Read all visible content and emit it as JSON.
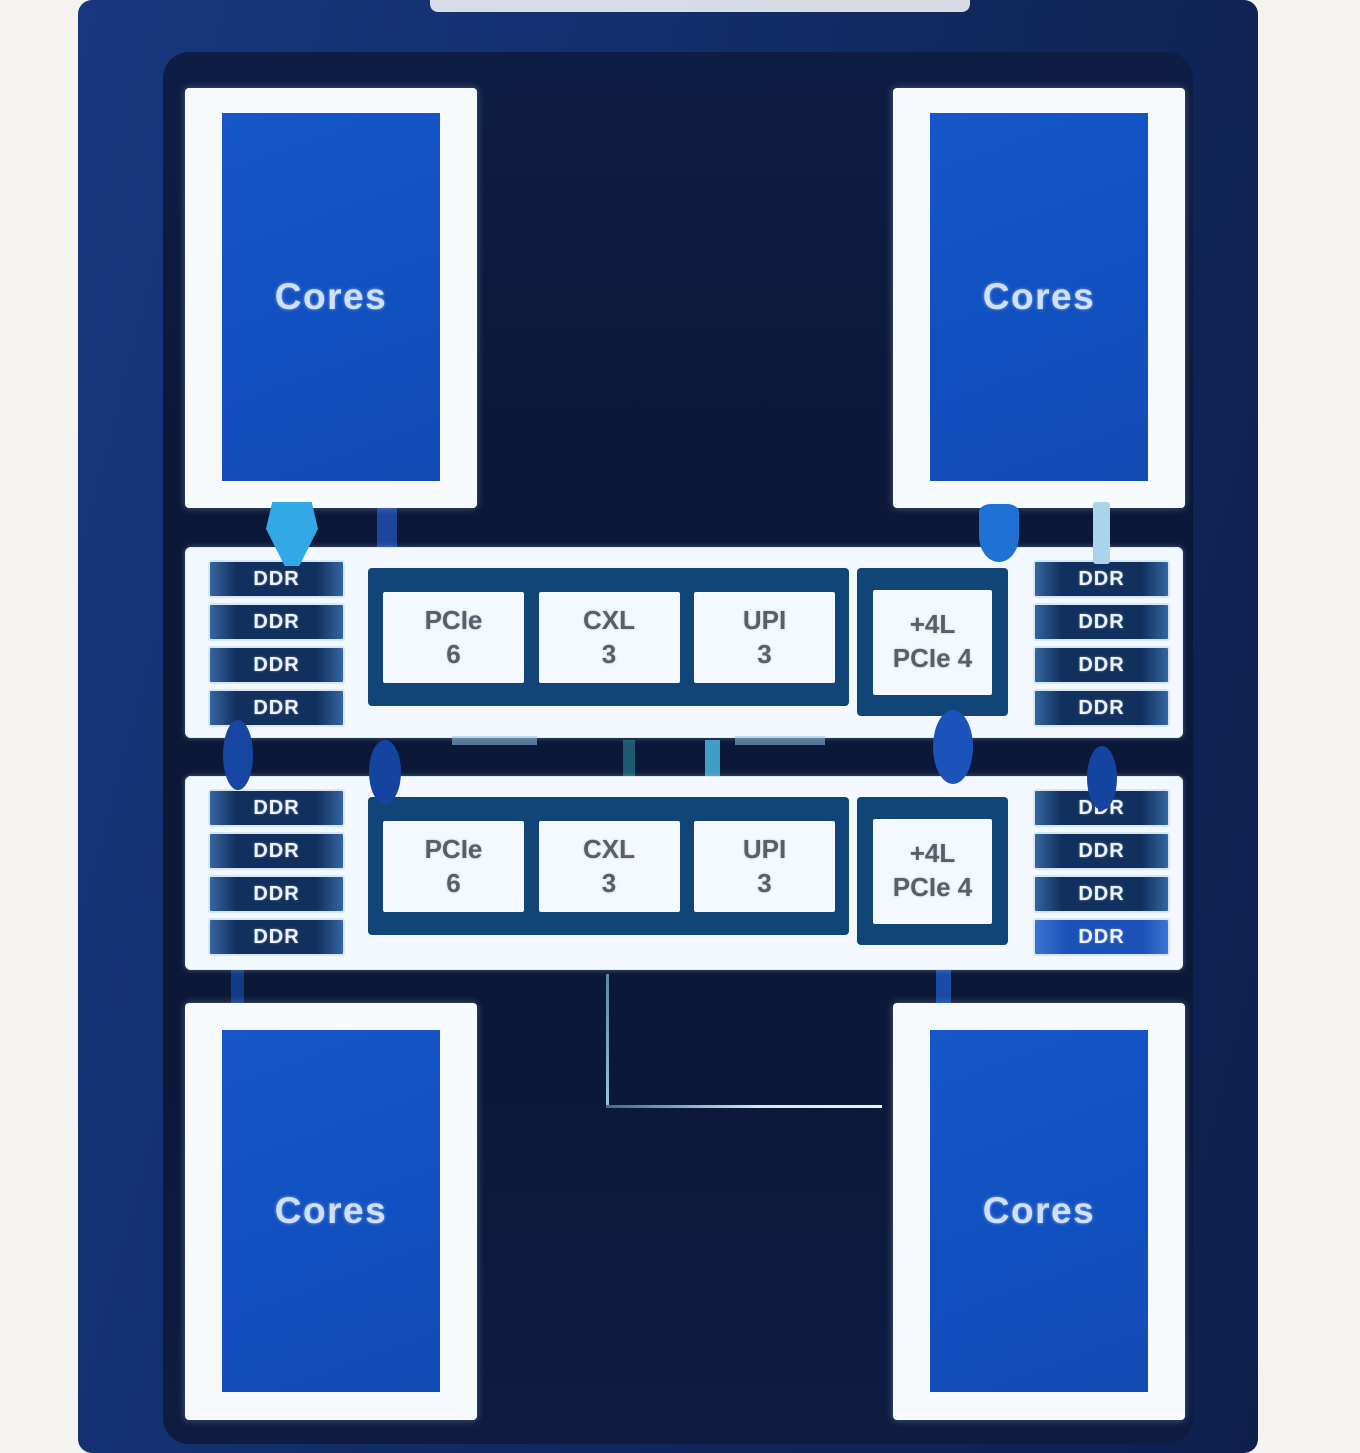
{
  "diagram": {
    "title": "dual-die processor package diagram",
    "core_blocks": [
      {
        "position": "top-left",
        "label": "Cores"
      },
      {
        "position": "top-right",
        "label": "Cores"
      },
      {
        "position": "bottom-left",
        "label": "Cores"
      },
      {
        "position": "bottom-right",
        "label": "Cores"
      }
    ],
    "io_rows": [
      {
        "ddr_left": [
          "DDR",
          "DDR",
          "DDR",
          "DDR"
        ],
        "ddr_right": [
          "DDR",
          "DDR",
          "DDR",
          "DDR"
        ],
        "hub_blocks": [
          {
            "line1": "PCIe",
            "line2": "6"
          },
          {
            "line1": "CXL",
            "line2": "3"
          },
          {
            "line1": "UPI",
            "line2": "3"
          }
        ],
        "plus_block": {
          "line1": "+4L",
          "line2": "PCIe 4"
        }
      },
      {
        "ddr_left": [
          "DDR",
          "DDR",
          "DDR",
          "DDR"
        ],
        "ddr_right": [
          "DDR",
          "DDR",
          "DDR",
          "DDR"
        ],
        "hub_blocks": [
          {
            "line1": "PCIe",
            "line2": "6"
          },
          {
            "line1": "CXL",
            "line2": "3"
          },
          {
            "line1": "UPI",
            "line2": "3"
          }
        ],
        "plus_block": {
          "line1": "+4L",
          "line2": "PCIe 4"
        }
      }
    ],
    "colors": {
      "frame_blue": "#16337a",
      "die_navy": "#0c1838",
      "core_blue": "#1251c2",
      "bar_white": "#f2f8fd",
      "hub_blue": "#114477",
      "ddr_navy": "#11305e",
      "ddr_highlight": "#1c51b8",
      "link_cyan": "#32a8e6",
      "link_blue": "#1b53ba",
      "link_pale": "#a9d4ec"
    }
  }
}
